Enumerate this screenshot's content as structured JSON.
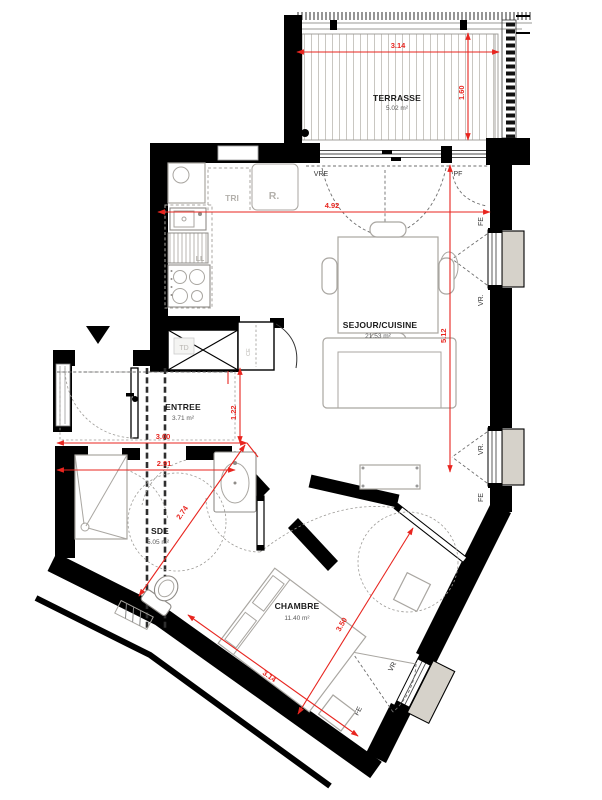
{
  "plan_title": "apartment-floor-plan",
  "colors": {
    "wall": "#000000",
    "dimension_red": "#e8251f",
    "furniture_gray": "#a9a6a1",
    "shutter_box": "#d6d2ca",
    "deck_line": "#c9c7c2"
  },
  "rooms": {
    "terrasse": {
      "name": "TERRASSE",
      "area": "5.02 m²"
    },
    "sejour": {
      "name": "SEJOUR/CUISINE",
      "area": "21.53 m²"
    },
    "entree": {
      "name": "ENTREE",
      "area": "3.71 m²"
    },
    "sde": {
      "name": "SDE",
      "area": "5.05 m²"
    },
    "chambre": {
      "name": "CHAMBRE",
      "area": "11.40 m²"
    }
  },
  "dimensions": {
    "terrace_width": "3.14",
    "terrace_depth": "1.60",
    "sejour_width": "4.92",
    "sejour_depth": "5.12",
    "entree_width": "3.00",
    "sde_width": "2.91",
    "entree_depth": "1.22",
    "sde_diagonal": "2.74",
    "chambre_depth": "3.50",
    "chambre_width": "3.14"
  },
  "openings": {
    "sliding_bay": "VRE",
    "french_door": "PF",
    "window1_top": "FE",
    "window1_bottom": "VR.",
    "window2_top": "VR.",
    "window2_bottom": "FE",
    "chambre_window_top": "VR",
    "chambre_window_bottom": "FE"
  },
  "equipment": {
    "waste_sorting": "TRI",
    "fridge": "R.",
    "washer": "LL",
    "duct": "TD",
    "water_heater": "CE"
  }
}
